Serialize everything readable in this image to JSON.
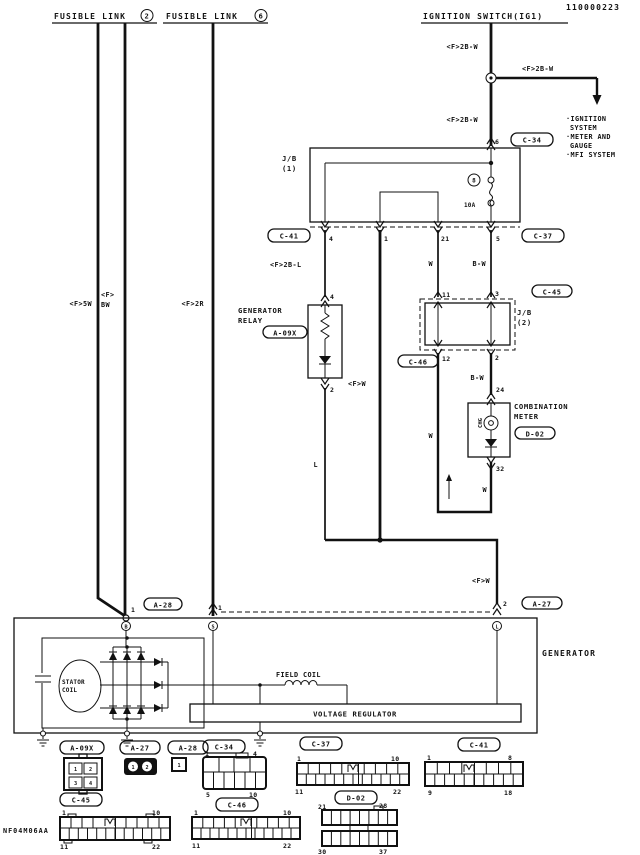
{
  "doc_number": "110000223",
  "footer_code": "NF04M06AA",
  "power_sources": {
    "fusible_link_2": {
      "name": "FUSIBLE LINK",
      "number": "2"
    },
    "fusible_link_6": {
      "name": "FUSIBLE LINK",
      "number": "6"
    },
    "ignition_switch": {
      "name": "IGNITION SWITCH(IG1)"
    }
  },
  "branch": {
    "destination_lines": [
      "·IGNITION",
      "SYSTEM",
      "·METER AND",
      "GAUGE",
      "·MFI SYSTEM"
    ]
  },
  "wire_codes": {
    "ign_top": "<F>2B-W",
    "ign_branch": "<F>2B-W",
    "ign_lower": "<F>2B-W",
    "fl2_left": "<F>5W",
    "fl2_right_l1": "<F>",
    "fl2_right_l2": "BW",
    "fl6": "<F>2R",
    "jb1_to_relay": "<F>2B-L",
    "jb1_out_w": "W",
    "jb1_out_bw": "B-W",
    "relay_out": "<F>W",
    "jb2_out_bw": "B-W",
    "meter_in_w": "W",
    "meter_out_w": "W",
    "relay_l": "L",
    "gen_l_in": "<F>W"
  },
  "connector_refs": {
    "c34": "C-34",
    "c37": "C-37",
    "c41": "C-41",
    "c45": "C-45",
    "c46": "C-46",
    "d02": "D-02",
    "a09x": "A-09X",
    "a27": "A-27",
    "a28": "A-28"
  },
  "jb1": {
    "label_l1": "J/B",
    "label_l2": "(1)",
    "fuse_number": "8",
    "fuse_rating": "10A",
    "pin_in": "6",
    "pin_out_1": "4",
    "pin_out_2": "1",
    "pin_out_3": "21",
    "pin_out_4": "5"
  },
  "jb2": {
    "label_l1": "J/B",
    "label_l2": "(2)",
    "pin_in_1": "11",
    "pin_in_2": "3",
    "pin_out_1": "12",
    "pin_out_2": "2"
  },
  "generator_relay": {
    "label_l1": "GENERATOR",
    "label_l2": "RELAY",
    "pin_in": "4",
    "pin_out": "2"
  },
  "combination_meter": {
    "label_l1": "COMBINATION",
    "label_l2": "METER",
    "lamp": "CHG",
    "pin_in": "24",
    "pin_out": "32"
  },
  "generator": {
    "label": "GENERATOR",
    "pin_b": "1",
    "pin_s": "1",
    "pin_l": "2",
    "term_b": "B",
    "term_s": "S",
    "term_l": "L",
    "stator_l1": "STATOR",
    "stator_l2": "COIL",
    "field_coil": "FIELD COIL",
    "voltage_regulator": "VOLTAGE REGULATOR"
  },
  "pinouts": {
    "a09x": {
      "label": "A-09X",
      "p1": "1",
      "p2": "2",
      "p3": "3",
      "p4": "4"
    },
    "a27": {
      "label": "A-27",
      "p1": "1",
      "p2": "2"
    },
    "a28": {
      "label": "A-28",
      "p1": "1"
    },
    "c34": {
      "label": "C-34",
      "tl": "1",
      "tr": "4",
      "bl": "5",
      "br": "10"
    },
    "c37": {
      "label": "C-37",
      "tl": "1",
      "tr": "10",
      "bl": "11",
      "br": "22"
    },
    "c41": {
      "label": "C-41",
      "tl": "1",
      "tr": "8",
      "bl": "9",
      "br": "18"
    },
    "c45": {
      "label": "C-45",
      "tl": "1",
      "tr": "10",
      "bl": "11",
      "br": "22"
    },
    "c46": {
      "label": "C-46",
      "tl": "1",
      "tr": "10",
      "bl": "11",
      "br": "22"
    },
    "d02": {
      "label": "D-02",
      "tl": "21",
      "tr": "28",
      "bl": "30",
      "br": "37"
    }
  }
}
